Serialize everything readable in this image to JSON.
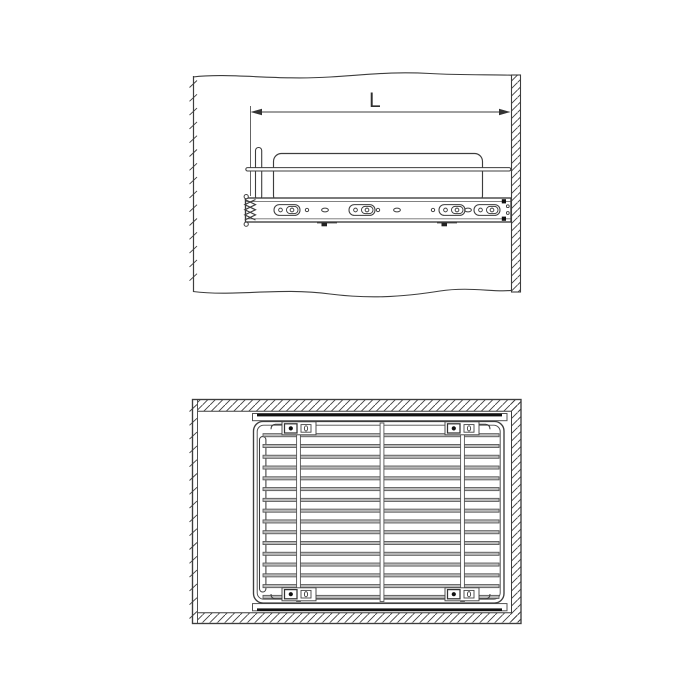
{
  "page": {
    "background": "#ffffff",
    "width": 700,
    "height": 700
  },
  "diagram": {
    "type": "technical-line-drawing",
    "subject": "pull-out wire basket with ball-bearing drawer slides mounted in cabinet",
    "colors": {
      "line": "#3d3d3d",
      "light_line": "#6f6f6f",
      "wire_fill": "#b9b9b9",
      "wire_edge": "#555555",
      "black": "#111111",
      "background": "#ffffff"
    },
    "side_view": {
      "dimension_label": "L",
      "dimension_font_px": 21,
      "left_edge": {
        "tick_start": 84,
        "tick_end": 290,
        "tick_spacing": 13.8
      },
      "rail": {
        "x": 245.5,
        "y": 198,
        "width": 265.5,
        "height": 24
      },
      "slot_centers_x": [
        287,
        362,
        452,
        487
      ],
      "hole_centers_x": [
        307,
        378,
        433
      ],
      "oval_centers_x": [
        325,
        397,
        468
      ],
      "slot_center_y": 210
    },
    "plan_view": {
      "left_edge": {
        "tick_start": 408,
        "tick_end": 618,
        "tick_spacing": 13.8
      },
      "wire_count": 16,
      "wire_x": 263,
      "wire_width": 236,
      "wire_y_start": 435.2,
      "wire_y_step": 10.78,
      "vertical_wire_x": [
        298.5,
        382,
        462.5
      ],
      "bracket_columns_x": [
        299,
        462
      ],
      "bracket_row_top_y": 421.8,
      "bracket_row_bottom_y": 587.8
    }
  }
}
